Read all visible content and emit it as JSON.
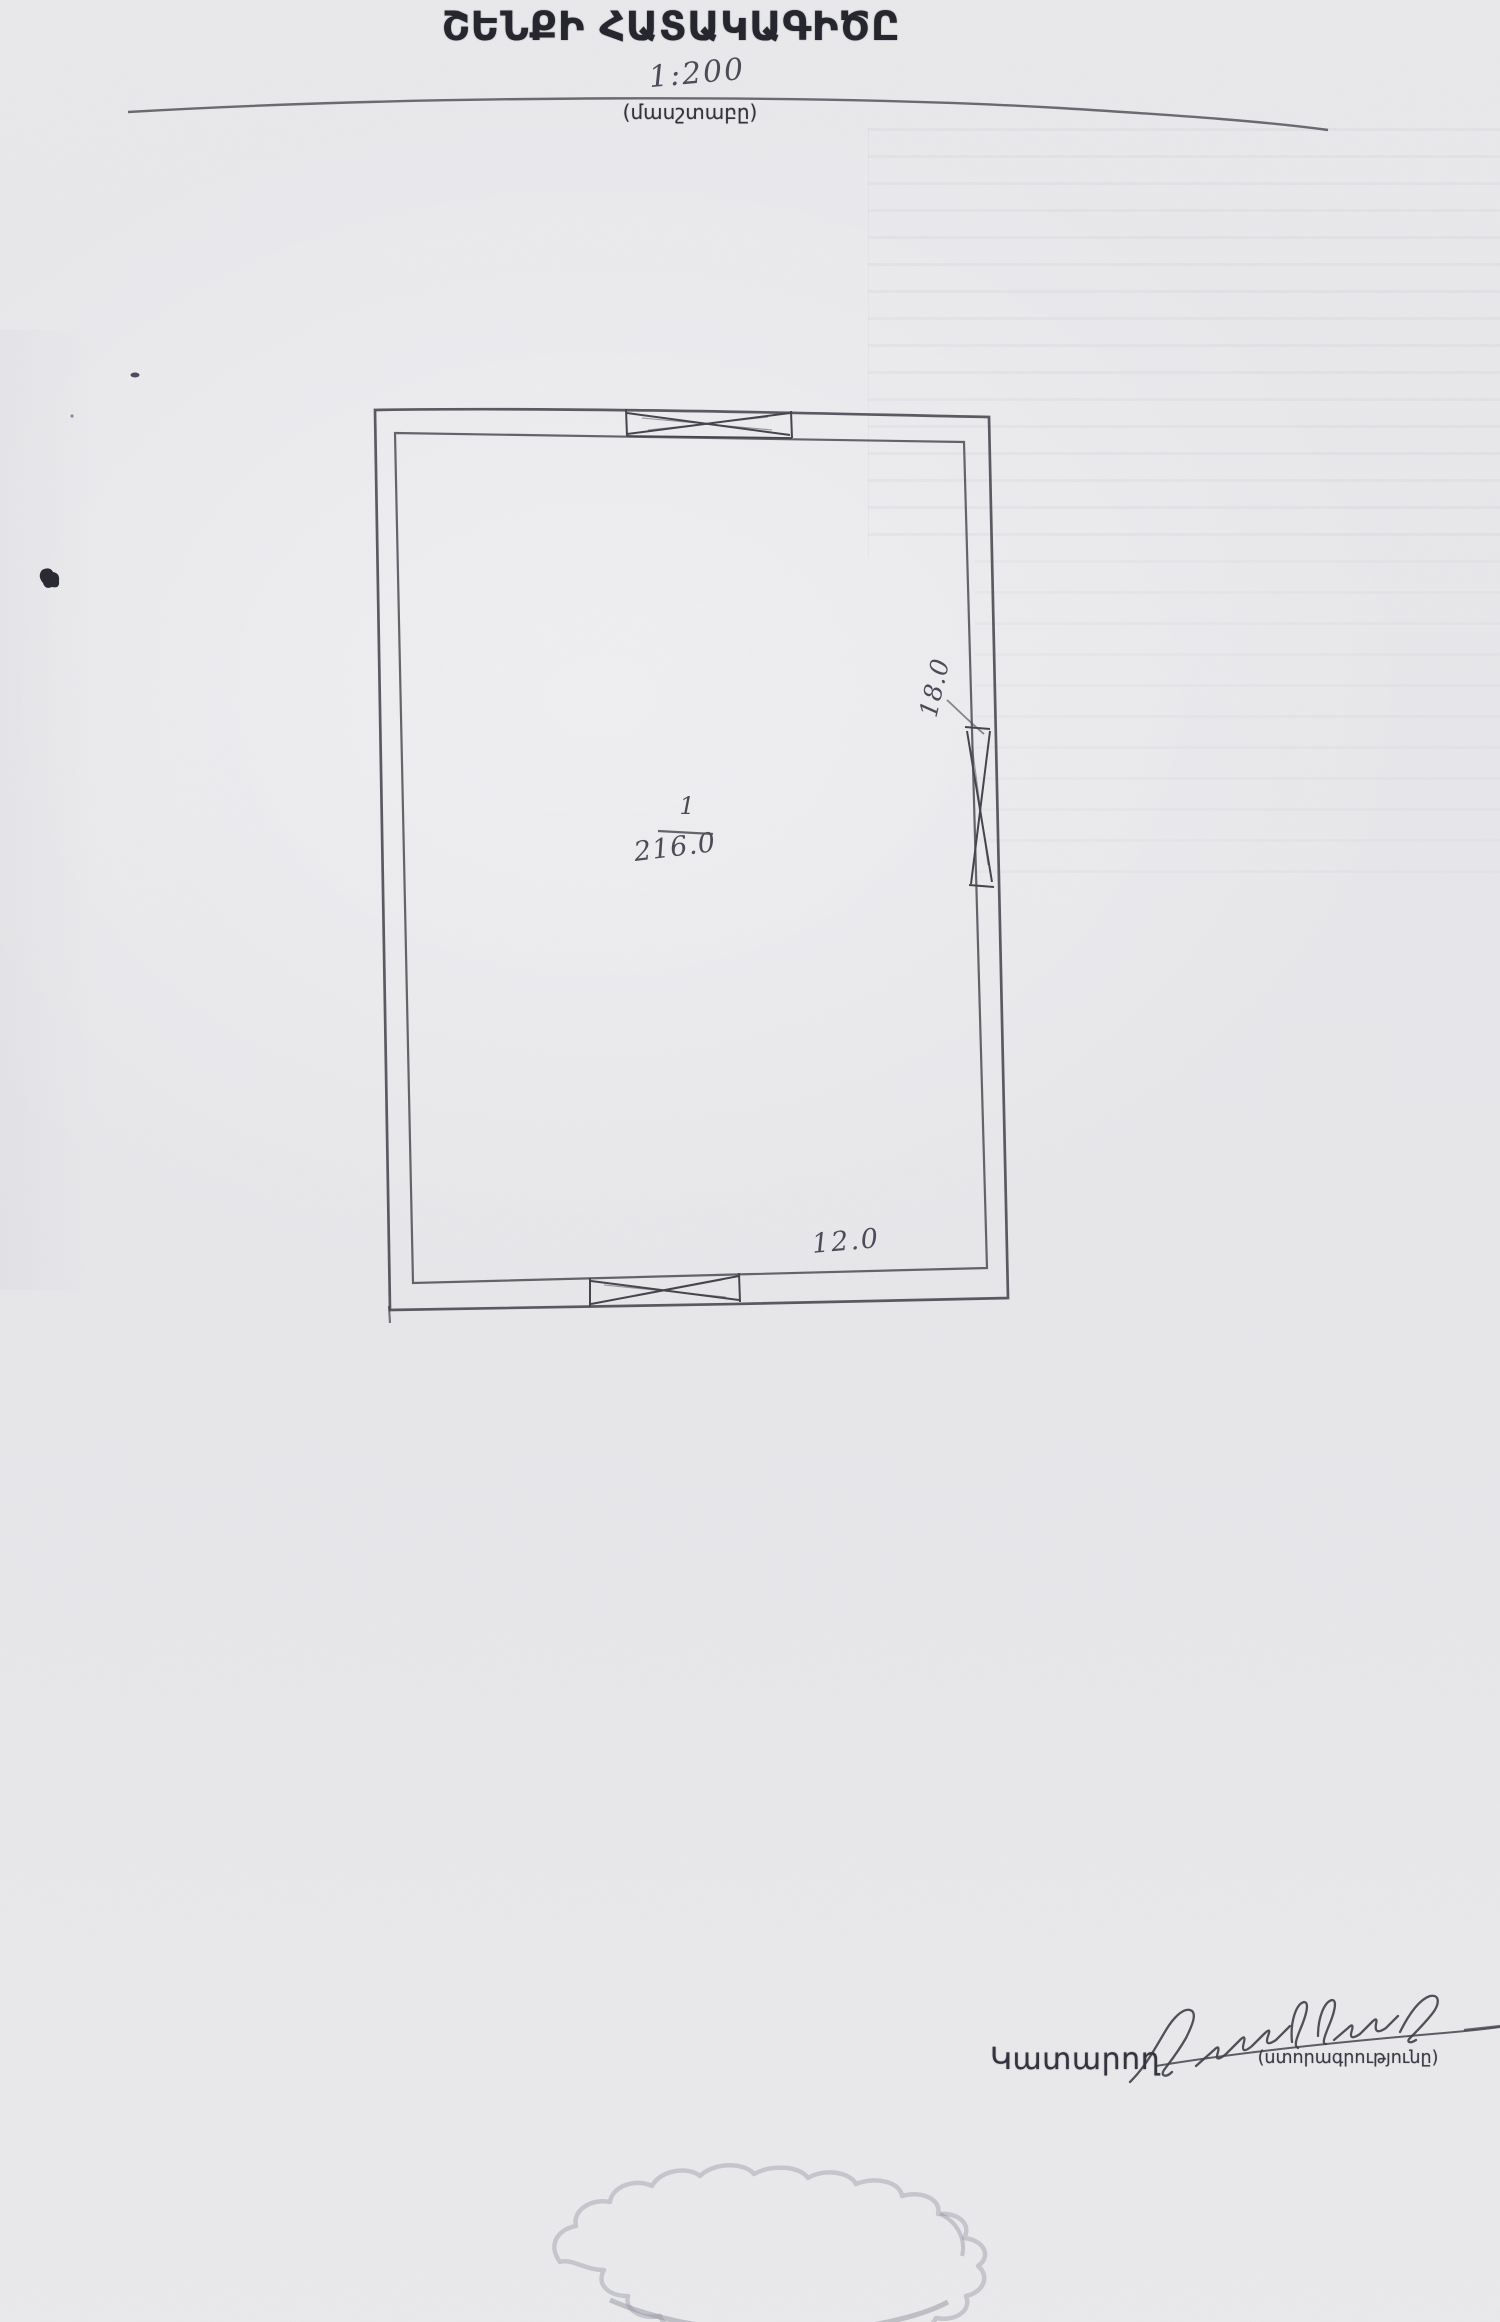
{
  "document": {
    "title": "ՇԵՆՔԻ ՀԱՏԱԿԱԳԻԾԸ",
    "scale": {
      "value": "1:200",
      "caption": "(մասշտաբը)"
    }
  },
  "floor_plan": {
    "room": {
      "number": "1",
      "area": "216.0"
    },
    "dimensions": {
      "bottom_width": "12.0",
      "right_height": "18.0"
    }
  },
  "footer": {
    "executor_label": "Կատարող",
    "signature_caption": "(ստորագրությունը)"
  },
  "colors": {
    "paper": "#e8e8eb",
    "ink": "#42424b",
    "print_text": "#26262e",
    "stamp_outline": "#adadb9"
  }
}
